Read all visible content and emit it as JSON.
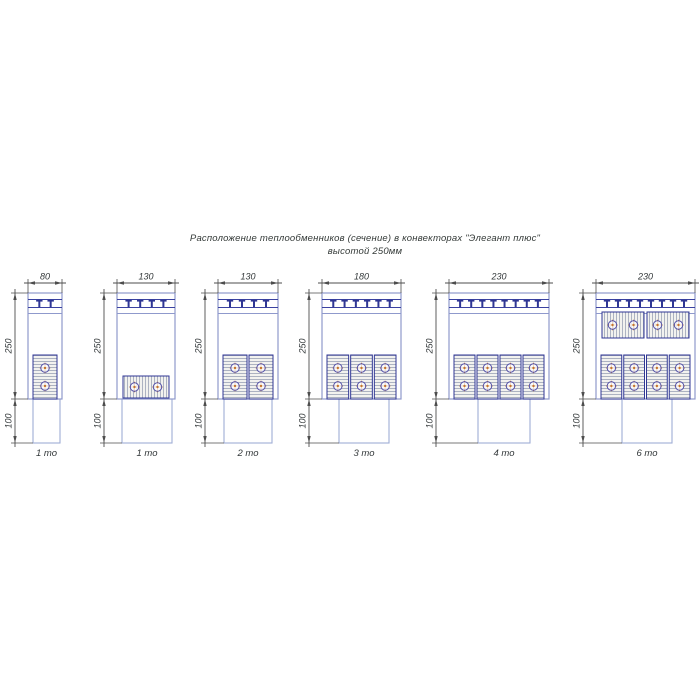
{
  "title": {
    "line1": "Расположение теплообменников (сечение) в конвекторах \"Элегант плюс\"",
    "line2": "высотой 250мм"
  },
  "colors": {
    "outline_light": "#8f99cc",
    "duct_outline": "#9fadd6",
    "navy": "#2f3694",
    "grille_line": "#3a41a0",
    "fin_line": "#9aa2b6",
    "fin_bg": "#f2f2ef",
    "tube_stroke": "#5552a8",
    "tube_cross": "#c4752e",
    "dimension": "#4d4d4d",
    "text": "#33383a"
  },
  "diagrams": [
    {
      "caption": "1 то",
      "width_label": "80",
      "height_label": "250",
      "duct_height_label": "100",
      "grille_teeth": 2,
      "banks": [
        {
          "orientation": "vertical",
          "position": "bottom",
          "exchangers": 1,
          "tubes_per_exchanger": 2
        }
      ]
    },
    {
      "caption": "1 то",
      "width_label": "130",
      "height_label": "250",
      "duct_height_label": "100",
      "grille_teeth": 4,
      "banks": [
        {
          "orientation": "horizontal",
          "position": "bottom",
          "exchangers": 1,
          "tubes_per_exchanger": 2
        }
      ]
    },
    {
      "caption": "2 то",
      "width_label": "130",
      "height_label": "250",
      "duct_height_label": "100",
      "grille_teeth": 4,
      "banks": [
        {
          "orientation": "vertical",
          "position": "bottom",
          "exchangers": 2,
          "tubes_per_exchanger": 2
        }
      ]
    },
    {
      "caption": "3 то",
      "width_label": "180",
      "height_label": "250",
      "duct_height_label": "100",
      "grille_teeth": 6,
      "banks": [
        {
          "orientation": "vertical",
          "position": "bottom",
          "exchangers": 3,
          "tubes_per_exchanger": 2
        }
      ]
    },
    {
      "caption": "4 то",
      "width_label": "230",
      "height_label": "250",
      "duct_height_label": "100",
      "grille_teeth": 8,
      "banks": [
        {
          "orientation": "vertical",
          "position": "bottom",
          "exchangers": 4,
          "tubes_per_exchanger": 2
        }
      ]
    },
    {
      "caption": "6 то",
      "width_label": "230",
      "height_label": "250",
      "duct_height_label": "100",
      "grille_teeth": 8,
      "banks": [
        {
          "orientation": "horizontal",
          "position": "top",
          "exchangers": 2,
          "tubes_per_exchanger": 2
        },
        {
          "orientation": "vertical",
          "position": "bottom",
          "exchangers": 4,
          "tubes_per_exchanger": 2
        }
      ]
    }
  ]
}
